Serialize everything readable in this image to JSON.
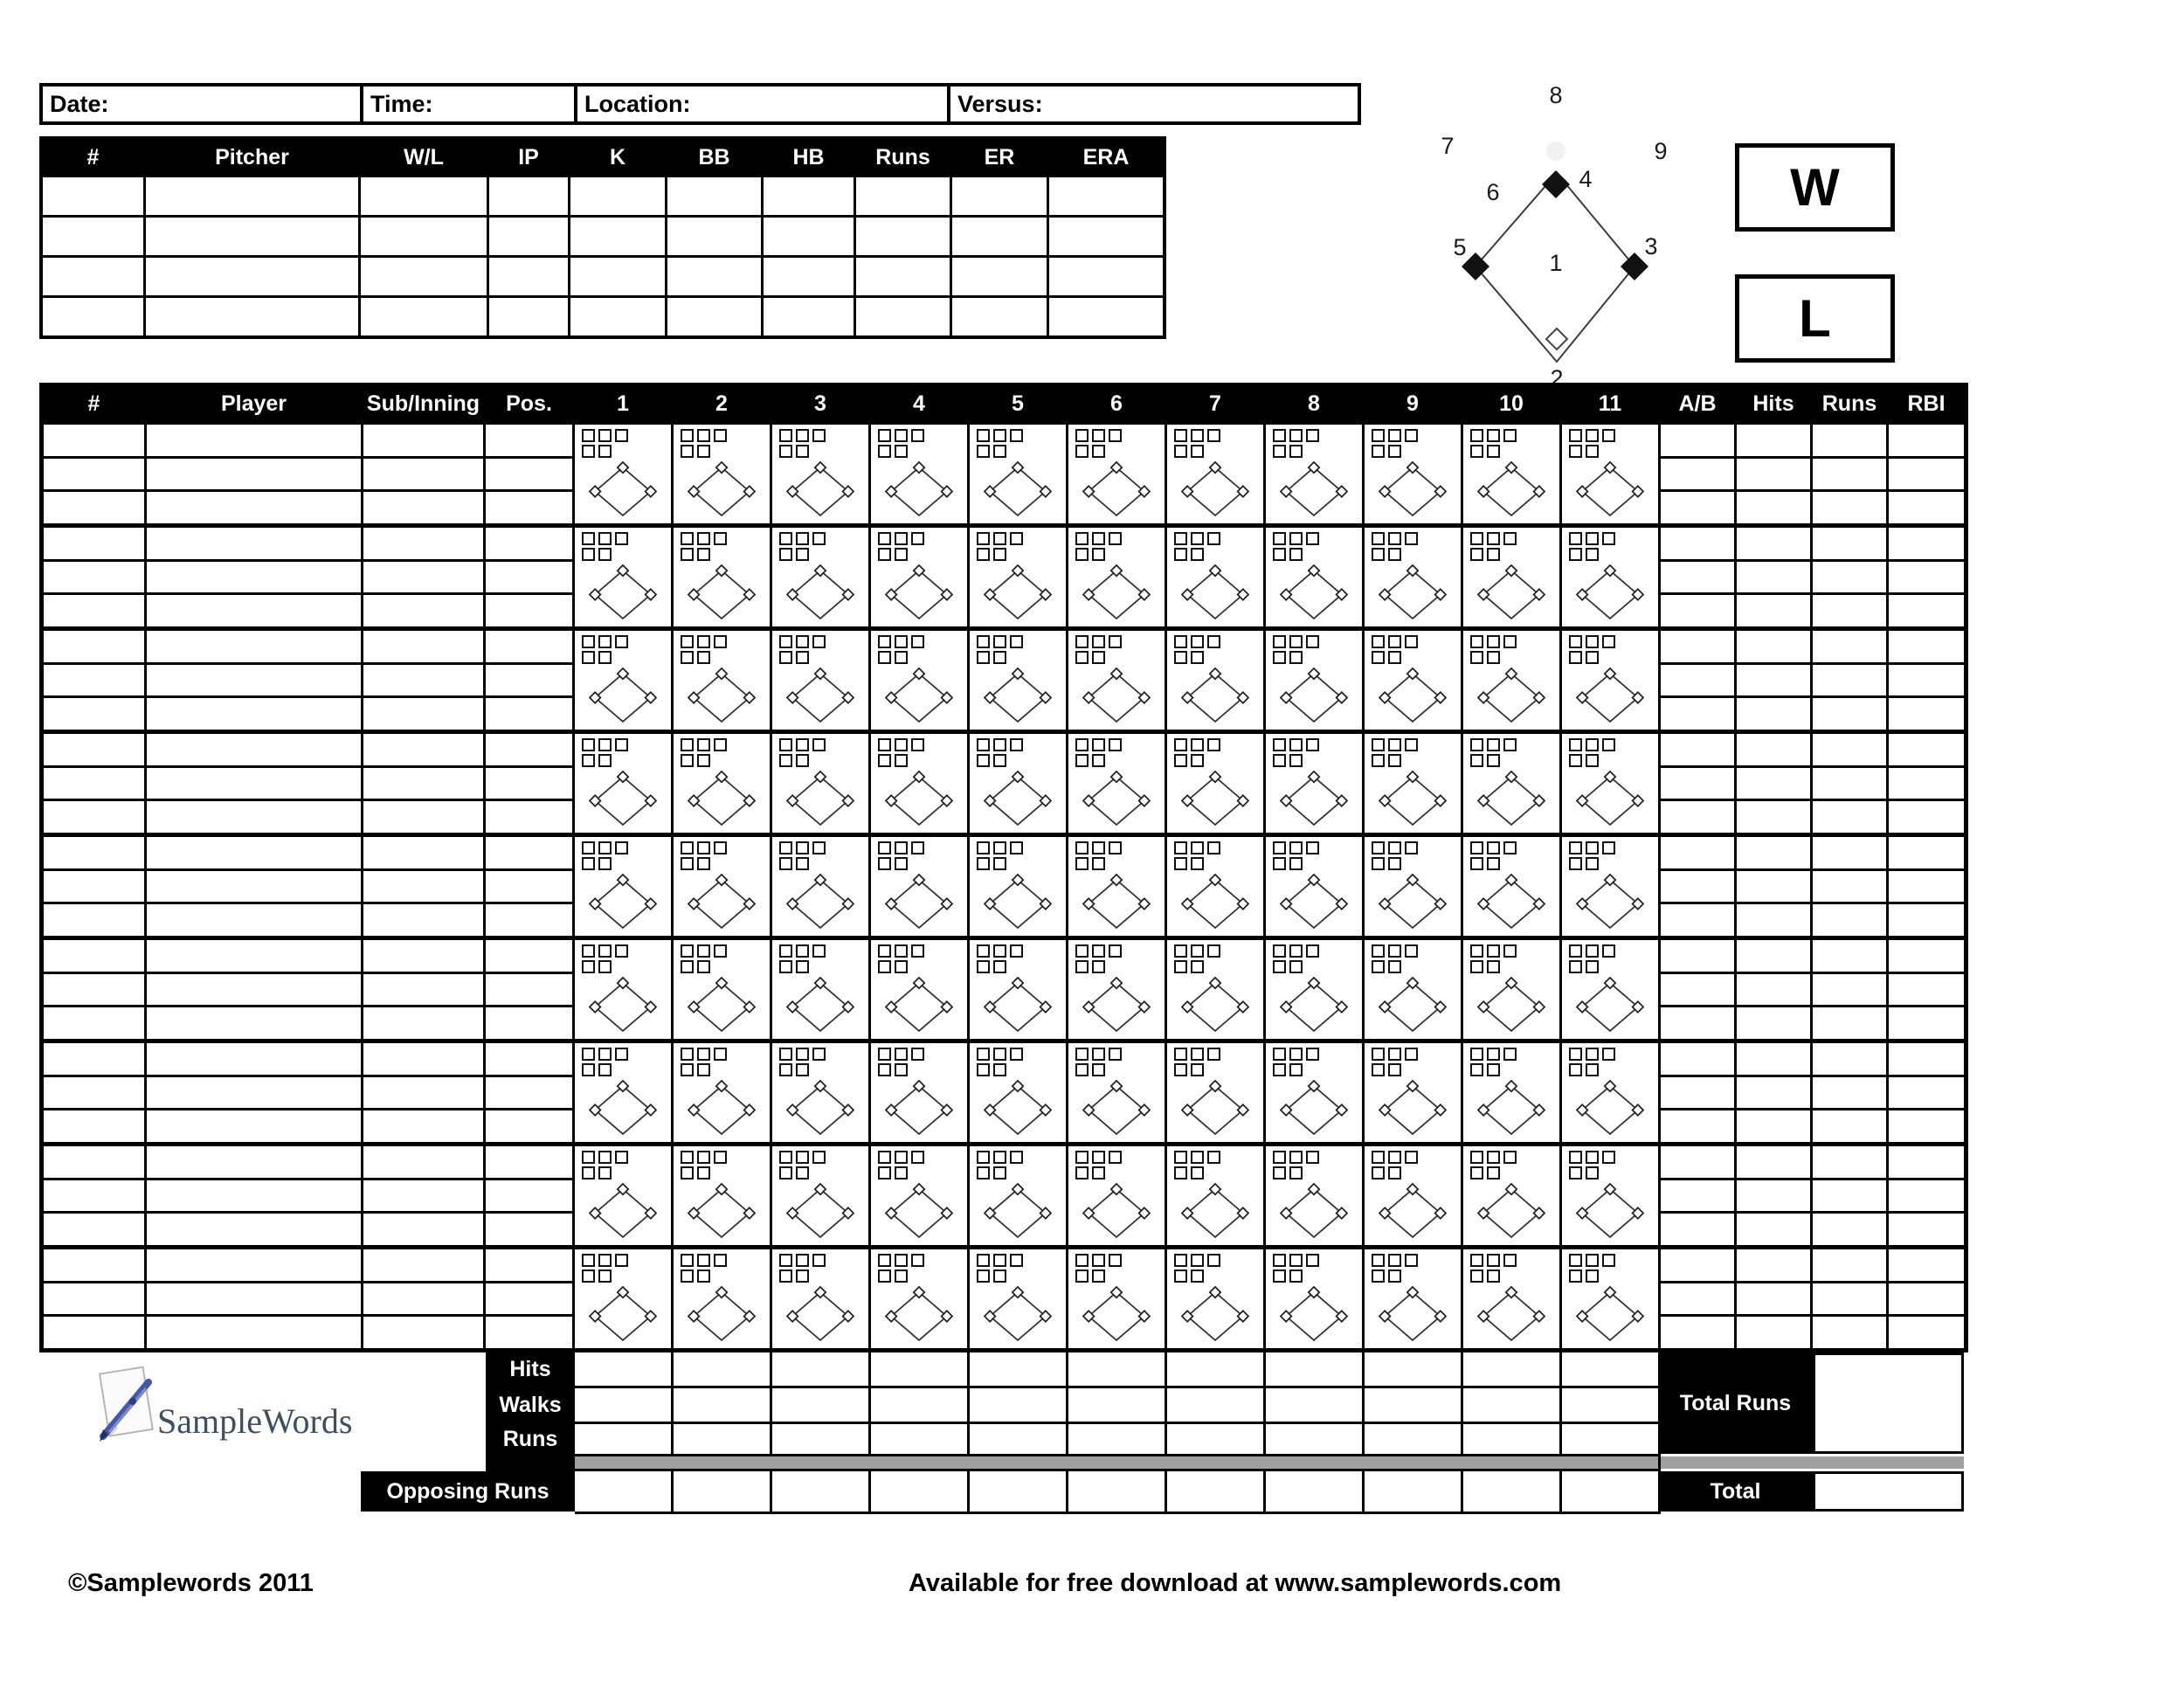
{
  "colors": {
    "ink": "#000000",
    "gray_bar": "#a0a0a0",
    "logo_text": "#3c4f63",
    "logo_pen": "#4458a8"
  },
  "game_info": {
    "fields": [
      {
        "id": "date",
        "label": "Date:"
      },
      {
        "id": "time",
        "label": "Time:"
      },
      {
        "id": "location",
        "label": "Location:"
      },
      {
        "id": "versus",
        "label": "Versus:"
      }
    ]
  },
  "pitcher_table": {
    "headers": [
      "#",
      "Pitcher",
      "W/L",
      "IP",
      "K",
      "BB",
      "HB",
      "Runs",
      "ER",
      "ERA"
    ],
    "empty_rows": 4
  },
  "field_diagram": {
    "position_labels": [
      "1",
      "2",
      "3",
      "4",
      "5",
      "6",
      "7",
      "8",
      "9"
    ]
  },
  "result_boxes": {
    "win": "W",
    "loss": "L"
  },
  "batting_table": {
    "left_headers": [
      "#",
      "Player",
      "Sub/Inning",
      "Pos."
    ],
    "innings": [
      "1",
      "2",
      "3",
      "4",
      "5",
      "6",
      "7",
      "8",
      "9",
      "10",
      "11"
    ],
    "right_headers": [
      "A/B",
      "Hits",
      "Runs",
      "RBI"
    ],
    "player_rows": 9,
    "sub_rows_per_player": 3
  },
  "summary": {
    "row_labels": [
      "Hits",
      "Walks",
      "Runs"
    ],
    "opposing_label": "Opposing Runs",
    "total_runs_label": "Total Runs",
    "total_label": "Total"
  },
  "logo": {
    "text": "SampleWords"
  },
  "footer": {
    "copyright": "©Samplewords 2011",
    "download_note": "Available for free download at www.samplewords.com"
  }
}
